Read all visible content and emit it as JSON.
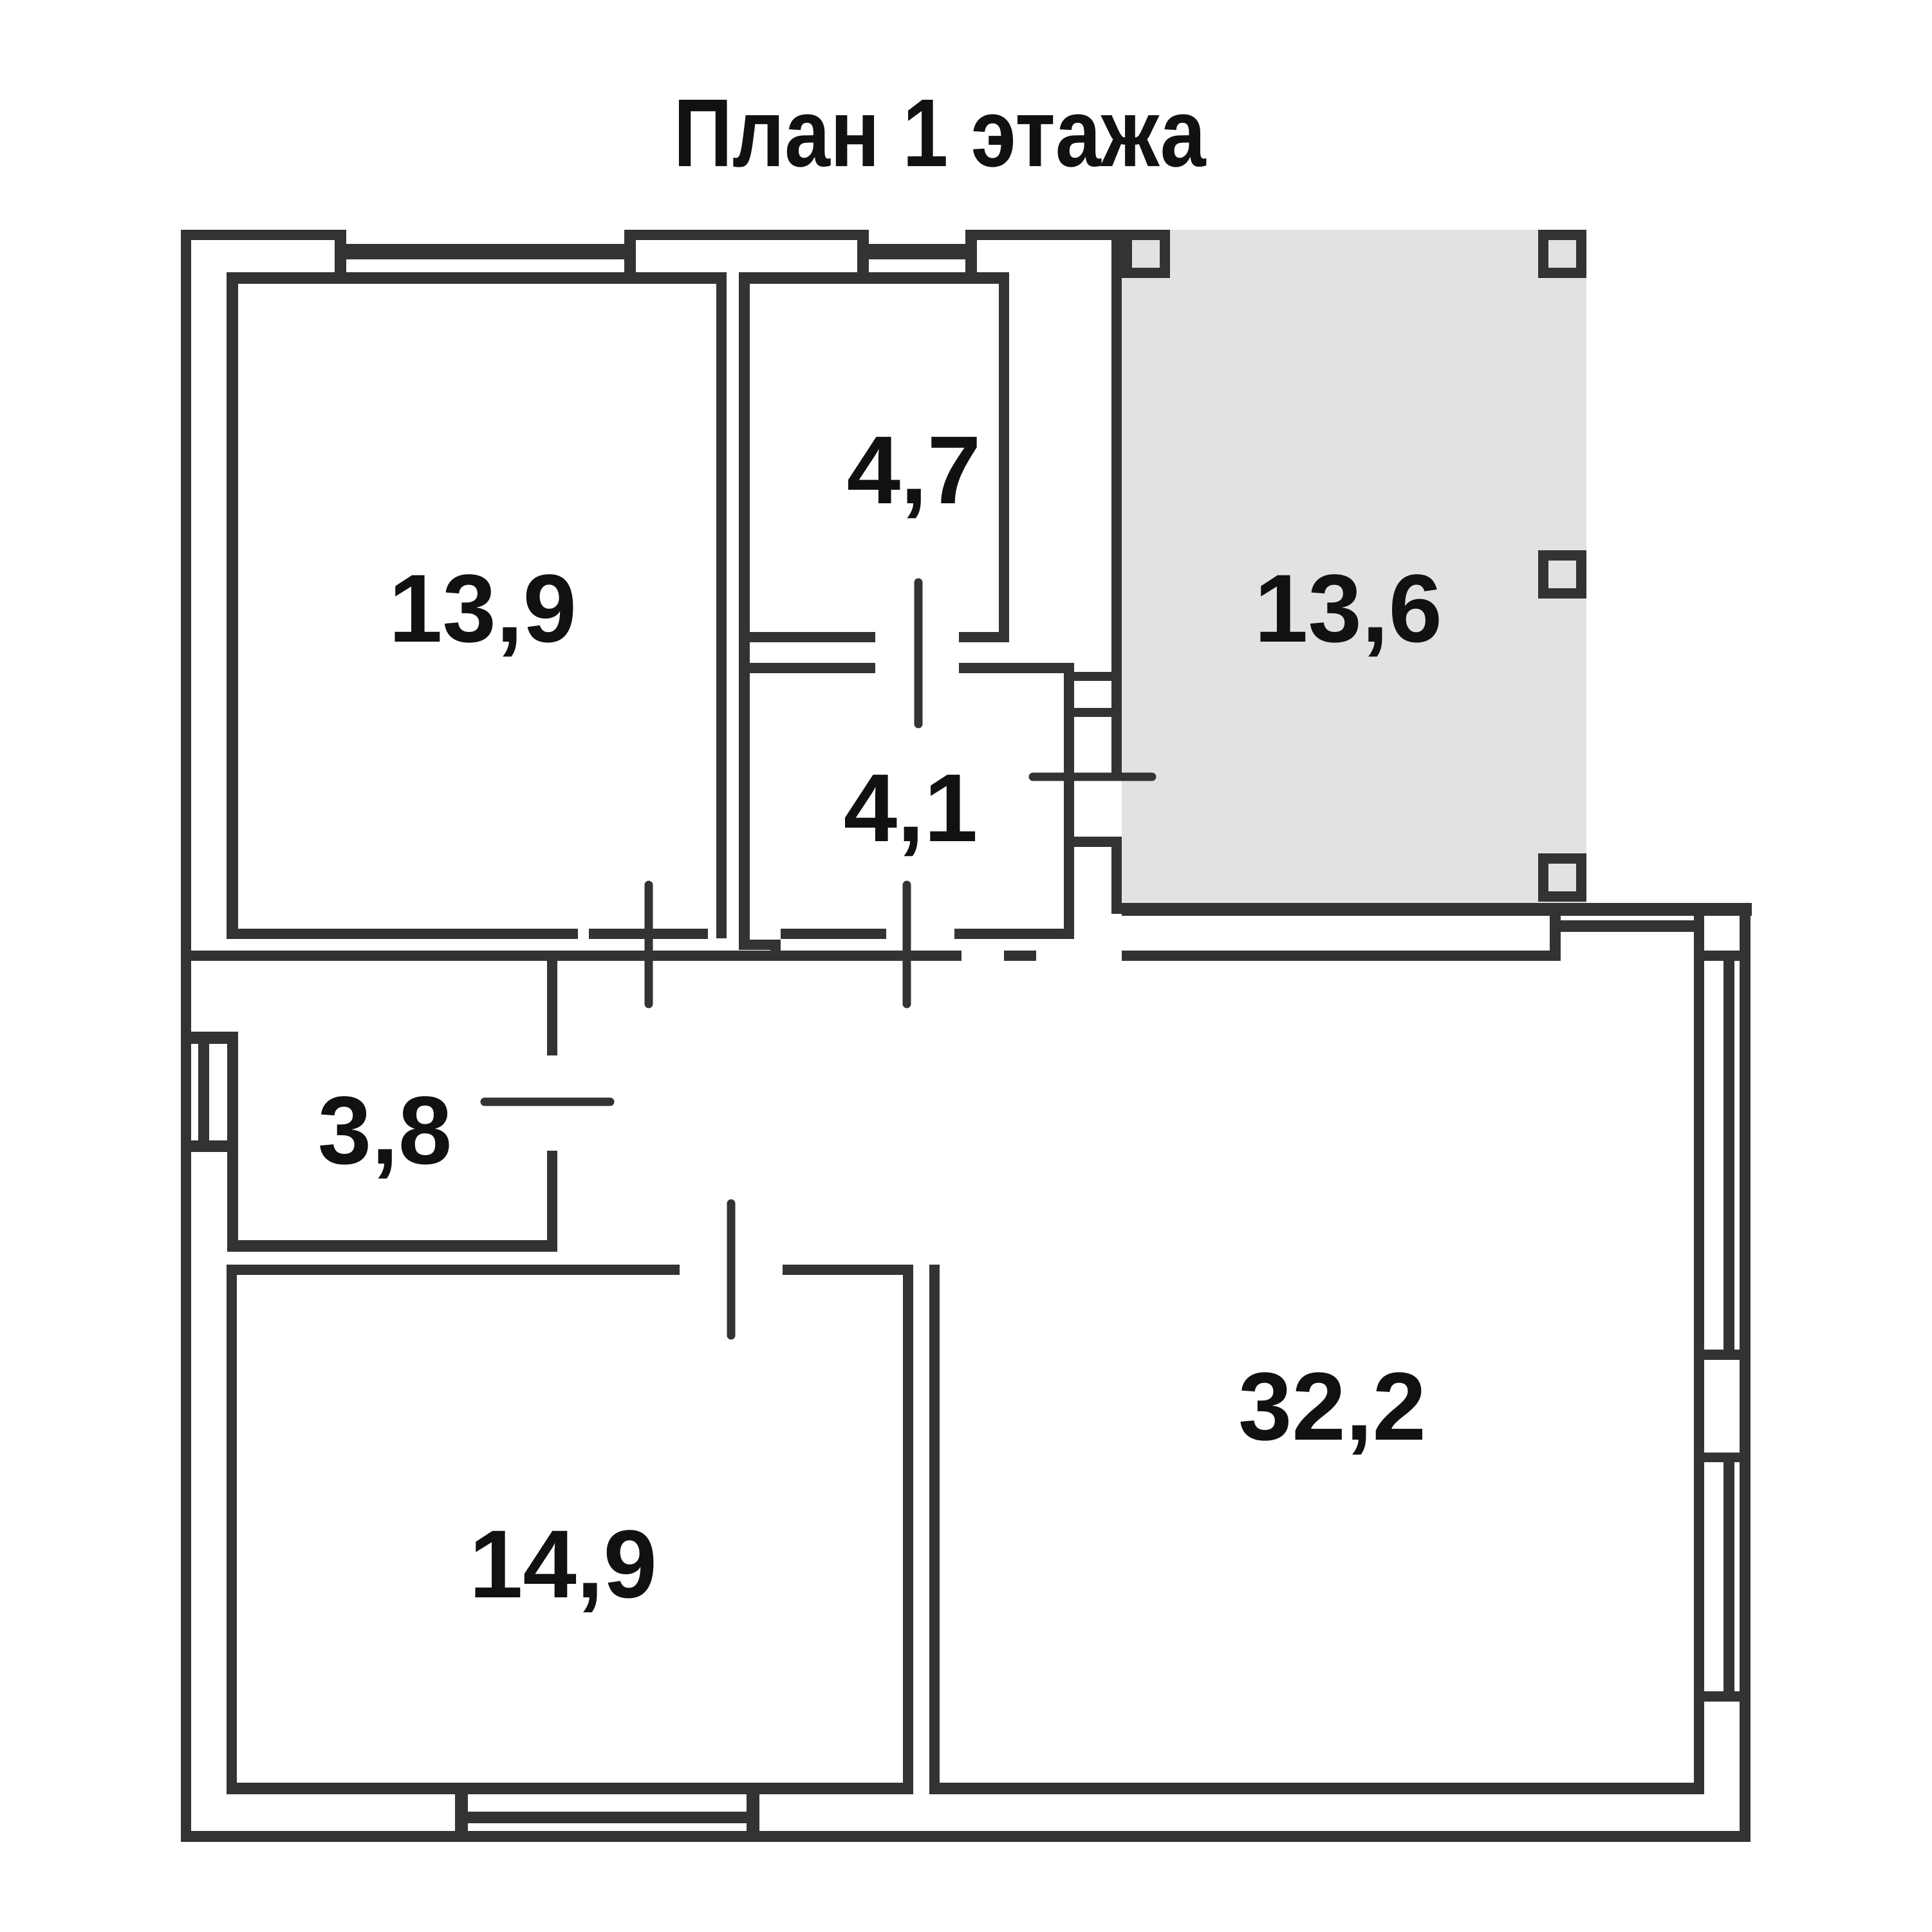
{
  "title": "План 1 этажа",
  "colors": {
    "wall": "#333333",
    "terrace_fill": "#e2e2e2",
    "label_text": "#111111",
    "background": "#ffffff"
  },
  "rooms": [
    {
      "name": "room-13-9",
      "area_label": "13,9"
    },
    {
      "name": "room-4-7",
      "area_label": "4,7"
    },
    {
      "name": "room-4-1",
      "area_label": "4,1"
    },
    {
      "name": "terrace-13-6",
      "area_label": "13,6"
    },
    {
      "name": "room-3-8",
      "area_label": "3,8"
    },
    {
      "name": "room-14-9",
      "area_label": "14,9"
    },
    {
      "name": "room-32-2",
      "area_label": "32,2"
    }
  ]
}
